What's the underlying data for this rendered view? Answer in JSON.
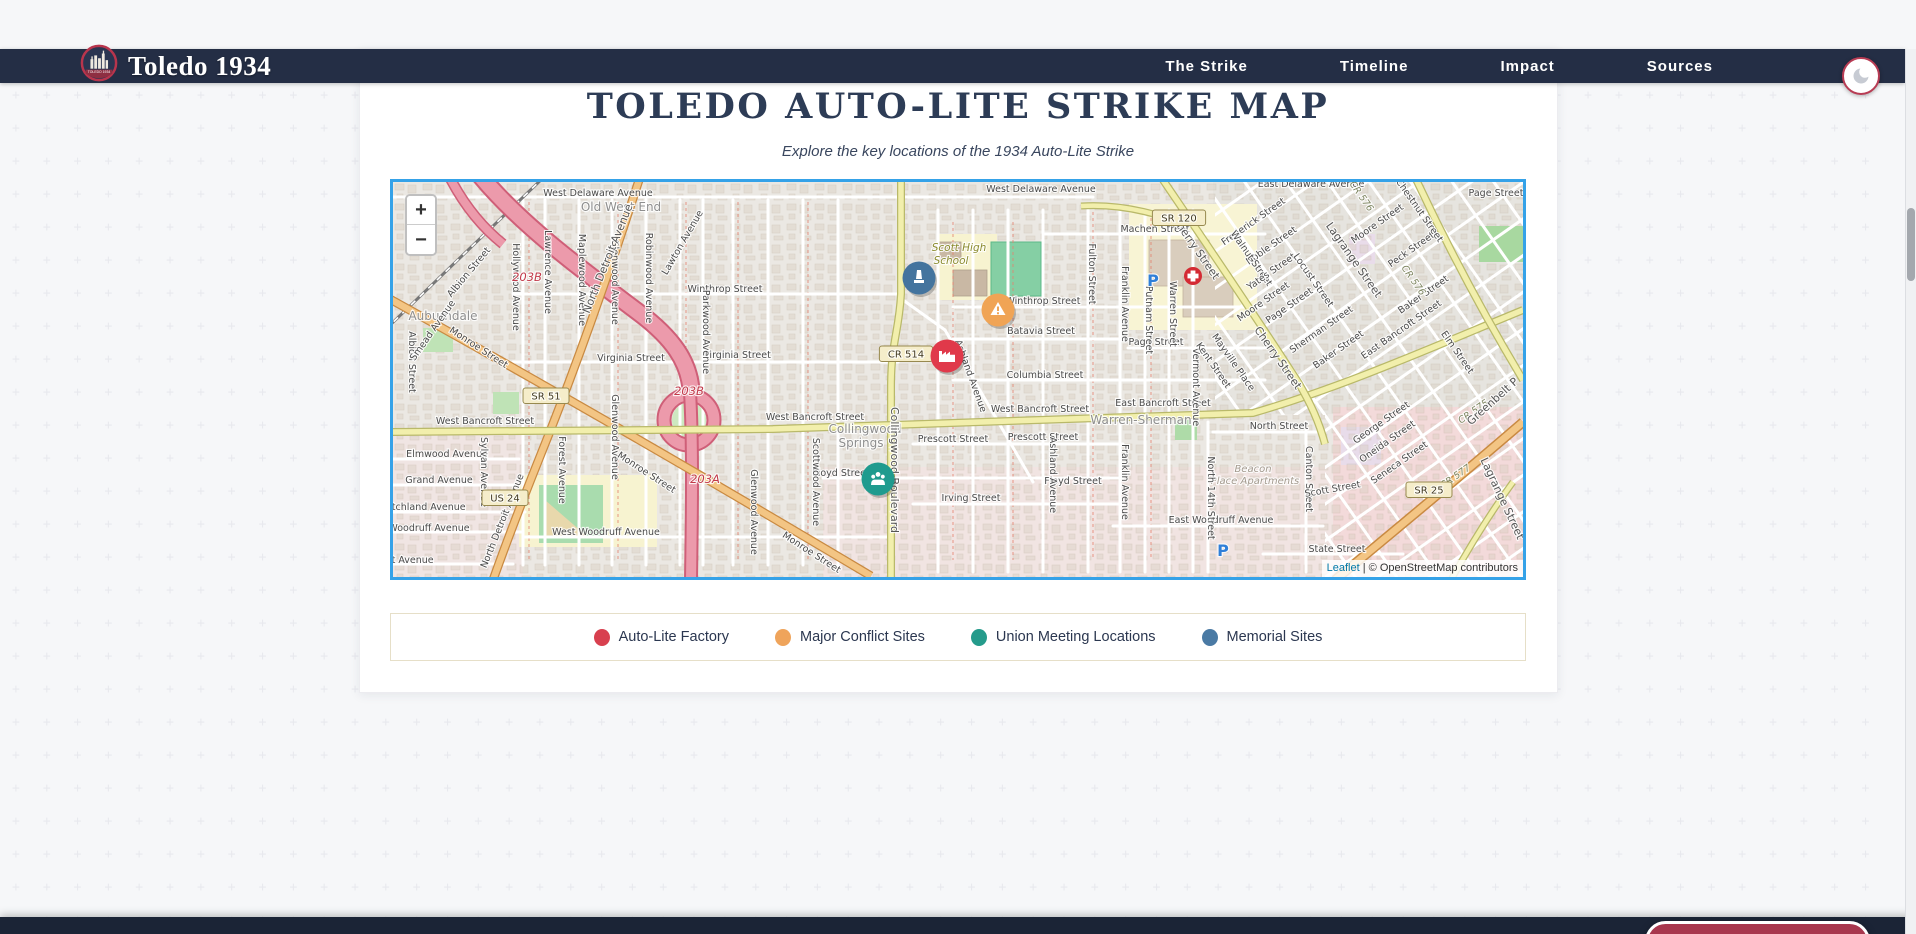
{
  "navbar": {
    "brand": "Toledo 1934",
    "logo_badge_text": "TOLEDO 1934",
    "links": [
      {
        "label": "The Strike"
      },
      {
        "label": "Timeline"
      },
      {
        "label": "Impact"
      },
      {
        "label": "Sources"
      }
    ]
  },
  "hero": {
    "title": "TOLEDO AUTO-LITE STRIKE MAP",
    "subtitle": "Explore the key locations of the 1934 Auto-Lite Strike"
  },
  "map": {
    "zoom_in": "+",
    "zoom_out": "−",
    "attribution": {
      "leaflet": "Leaflet",
      "separator": " | ",
      "osm": "© OpenStreetMap contributors"
    },
    "markers": [
      {
        "name": "Memorial Sites",
        "color": "#44749e",
        "x": 526,
        "y": 96,
        "icon": "memorial"
      },
      {
        "name": "Major Conflict Sites",
        "color": "#f0a455",
        "x": 605,
        "y": 128,
        "icon": "conflict"
      },
      {
        "name": "Auto-Lite Factory",
        "color": "#e0394a",
        "x": 554,
        "y": 174,
        "icon": "factory"
      },
      {
        "name": "Union Meeting Locations",
        "color": "#1f9b8e",
        "x": 485,
        "y": 297,
        "icon": "union"
      }
    ],
    "labels": [
      {
        "t": "West Delaware Avenue",
        "x": 205,
        "y": 14
      },
      {
        "t": "West Delaware Avenue",
        "x": 648,
        "y": 10
      },
      {
        "t": "East Delaware Avenue",
        "x": 918,
        "y": 5
      },
      {
        "t": "Old West End",
        "x": 228,
        "y": 29,
        "k": "area"
      },
      {
        "t": "Auburndale",
        "x": 50,
        "y": 138,
        "k": "area"
      },
      {
        "t": "Machen Street",
        "x": 762,
        "y": 50
      },
      {
        "t": "Winthrop Street",
        "x": 332,
        "y": 110
      },
      {
        "t": "Winthrop Street",
        "x": 650,
        "y": 122
      },
      {
        "t": "Virginia Street",
        "x": 238,
        "y": 179
      },
      {
        "t": "Virginia Street",
        "x": 344,
        "y": 176
      },
      {
        "t": "Batavia Street",
        "x": 648,
        "y": 152
      },
      {
        "t": "Page Street",
        "x": 763,
        "y": 163
      },
      {
        "t": "Columbia Street",
        "x": 652,
        "y": 196
      },
      {
        "t": "West Bancroft Street",
        "x": 92,
        "y": 242
      },
      {
        "t": "West Bancroft Street",
        "x": 422,
        "y": 238
      },
      {
        "t": "West Bancroft Street",
        "x": 647,
        "y": 230
      },
      {
        "t": "East Bancroft Street",
        "x": 770,
        "y": 224
      },
      {
        "t": "Warren-Sherman",
        "x": 748,
        "y": 242,
        "k": "area"
      },
      {
        "t": "Collingwood",
        "x": 472,
        "y": 251,
        "k": "area"
      },
      {
        "t": "Springs",
        "x": 468,
        "y": 265,
        "k": "area"
      },
      {
        "t": "Prescott Street",
        "x": 560,
        "y": 260
      },
      {
        "t": "Prescott Street",
        "x": 650,
        "y": 258
      },
      {
        "t": "Floyd Street",
        "x": 448,
        "y": 294
      },
      {
        "t": "Floyd Street",
        "x": 680,
        "y": 302
      },
      {
        "t": "Irving Street",
        "x": 578,
        "y": 319
      },
      {
        "t": "West Woodruff Avenue",
        "x": 213,
        "y": 353
      },
      {
        "t": "East Woodruff Avenue",
        "x": 828,
        "y": 341
      },
      {
        "t": "Elmwood Avenue",
        "x": 54,
        "y": 275
      },
      {
        "t": "Grand Avenue",
        "x": 46,
        "y": 301
      },
      {
        "t": "Fitchland Avenue",
        "x": 32,
        "y": 328
      },
      {
        "t": "Woodruff Avenue",
        "x": 36,
        "y": 349
      },
      {
        "t": "ct Avenue",
        "x": 17,
        "y": 381
      },
      {
        "t": "State Street",
        "x": 944,
        "y": 370
      },
      {
        "t": "North Street",
        "x": 886,
        "y": 247
      },
      {
        "t": "Beacon",
        "x": 860,
        "y": 290,
        "k": "apt"
      },
      {
        "t": "Place Apartments",
        "x": 862,
        "y": 302,
        "k": "apt"
      },
      {
        "t": "Scott High",
        "x": 566,
        "y": 69,
        "k": "poi"
      },
      {
        "t": "School",
        "x": 558,
        "y": 82,
        "k": "poi"
      },
      {
        "t": "Page Street",
        "x": 1103,
        "y": 14
      },
      {
        "t": "Lawrence Avenue",
        "x": 152,
        "y": 90,
        "r": 90
      },
      {
        "t": "Maplewood Avenue",
        "x": 186,
        "y": 98,
        "r": 90
      },
      {
        "t": "Glenwood Avenue",
        "x": 219,
        "y": 100,
        "r": 90
      },
      {
        "t": "Robinwood Avenue",
        "x": 253,
        "y": 96,
        "r": 90
      },
      {
        "t": "Parkwood Avenue",
        "x": 310,
        "y": 150,
        "r": 90
      },
      {
        "t": "Glenwood Avenue",
        "x": 219,
        "y": 255,
        "r": 90
      },
      {
        "t": "Glenwood Avenue",
        "x": 358,
        "y": 330,
        "r": 90
      },
      {
        "t": "Scottwood Avenue",
        "x": 420,
        "y": 300,
        "r": 90
      },
      {
        "t": "Hollywood Avenue",
        "x": 120,
        "y": 105,
        "r": 90
      },
      {
        "t": "Forest Avenue",
        "x": 166,
        "y": 288,
        "r": 90
      },
      {
        "t": "Sylvan Avenue",
        "x": 88,
        "y": 290,
        "r": 90
      },
      {
        "t": "Albion Street",
        "x": 16,
        "y": 180,
        "r": 90
      },
      {
        "t": "Fulton Street",
        "x": 696,
        "y": 92,
        "r": 90
      },
      {
        "t": "Franklin Avenue",
        "x": 729,
        "y": 122,
        "r": 90
      },
      {
        "t": "Franklin Avenue",
        "x": 729,
        "y": 300,
        "r": 90
      },
      {
        "t": "Putnam Street",
        "x": 753,
        "y": 138,
        "r": 90
      },
      {
        "t": "Warren Street",
        "x": 777,
        "y": 132,
        "r": 90
      },
      {
        "t": "Ashland Avenue",
        "x": 657,
        "y": 293,
        "r": 90
      },
      {
        "t": "Collingwood Boulevard",
        "x": 498,
        "y": 288,
        "r": 90,
        "k": "lg"
      },
      {
        "t": "North 14th Street",
        "x": 815,
        "y": 316,
        "r": 90
      },
      {
        "t": "Canton Street",
        "x": 913,
        "y": 297,
        "r": 90
      },
      {
        "t": "Vermont Avenue",
        "x": 800,
        "y": 205,
        "r": 90
      },
      {
        "t": "Kent Street",
        "x": 818,
        "y": 185,
        "r": 55
      },
      {
        "t": "Mayville Place",
        "x": 838,
        "y": 182,
        "r": 55
      },
      {
        "t": "North Detroit Avenue",
        "x": 218,
        "y": 78,
        "r": -68,
        "k": "lg"
      },
      {
        "t": "North Detroit Avenue",
        "x": 112,
        "y": 340,
        "r": -68
      },
      {
        "t": "Albion Street",
        "x": 78,
        "y": 92,
        "r": -50
      },
      {
        "t": "Lawton Avenue",
        "x": 292,
        "y": 62,
        "r": -60
      },
      {
        "t": "Smead Avenue",
        "x": 42,
        "y": 150,
        "r": -55
      },
      {
        "t": "Monroe Street",
        "x": 84,
        "y": 168,
        "r": 33
      },
      {
        "t": "Monroe Street",
        "x": 252,
        "y": 293,
        "r": 33
      },
      {
        "t": "Monroe Street",
        "x": 417,
        "y": 373,
        "r": 33
      },
      {
        "t": "Ashland Avenue",
        "x": 575,
        "y": 195,
        "r": 70
      },
      {
        "t": "Cherry Street",
        "x": 800,
        "y": 68,
        "r": 55,
        "k": "lg"
      },
      {
        "t": "Cherry Street",
        "x": 882,
        "y": 178,
        "r": 55,
        "k": "lg"
      },
      {
        "t": "Lagrange Street",
        "x": 958,
        "y": 80,
        "r": 55,
        "k": "lg"
      },
      {
        "t": "Lagrange Street",
        "x": 1106,
        "y": 318,
        "r": 65,
        "k": "lg"
      },
      {
        "t": "Frederick Street",
        "x": 862,
        "y": 42,
        "r": -35
      },
      {
        "t": "Noble Street",
        "x": 880,
        "y": 66,
        "r": -35
      },
      {
        "t": "Walnut Street",
        "x": 856,
        "y": 78,
        "r": 55
      },
      {
        "t": "Yates Street",
        "x": 880,
        "y": 92,
        "r": -35
      },
      {
        "t": "Moore Street",
        "x": 872,
        "y": 122,
        "r": -35
      },
      {
        "t": "Moore Street",
        "x": 986,
        "y": 44,
        "r": -35
      },
      {
        "t": "Locust Street",
        "x": 918,
        "y": 100,
        "r": 55
      },
      {
        "t": "Page Street",
        "x": 898,
        "y": 126,
        "r": -35
      },
      {
        "t": "Sherman Street",
        "x": 930,
        "y": 150,
        "r": -35
      },
      {
        "t": "Baker Street",
        "x": 947,
        "y": 170,
        "r": -35
      },
      {
        "t": "Baker Street",
        "x": 1032,
        "y": 115,
        "r": -35
      },
      {
        "t": "Peck Street",
        "x": 1020,
        "y": 70,
        "r": -35
      },
      {
        "t": "Chestnut Street",
        "x": 1024,
        "y": 30,
        "r": 55
      },
      {
        "t": "CR 576",
        "x": 966,
        "y": 16,
        "r": 55,
        "k": "ref2"
      },
      {
        "t": "CR 576",
        "x": 1018,
        "y": 100,
        "r": 55,
        "k": "ref2"
      },
      {
        "t": "East Bancroft Street",
        "x": 1010,
        "y": 150,
        "r": -35
      },
      {
        "t": "Elm Street",
        "x": 1062,
        "y": 172,
        "r": 55
      },
      {
        "t": "George Street",
        "x": 990,
        "y": 243,
        "r": -35
      },
      {
        "t": "Oneida Street",
        "x": 996,
        "y": 262,
        "r": -35
      },
      {
        "t": "Seneca Street",
        "x": 1008,
        "y": 283,
        "r": -35
      },
      {
        "t": "Scott Street",
        "x": 940,
        "y": 310,
        "r": -10
      },
      {
        "t": "CR 575",
        "x": 1082,
        "y": 232,
        "r": -35,
        "k": "ref2"
      },
      {
        "t": "CR 577",
        "x": 1064,
        "y": 297,
        "r": -35,
        "k": "ref2"
      },
      {
        "t": "Greenbelt P",
        "x": 1102,
        "y": 222,
        "r": -42,
        "k": "lg"
      },
      {
        "t": "203B",
        "x": 134,
        "y": 99,
        "k": "ref"
      },
      {
        "t": "203B",
        "x": 296,
        "y": 213,
        "k": "ref"
      },
      {
        "t": "203A",
        "x": 312,
        "y": 301,
        "k": "ref"
      },
      {
        "t": "SR 120",
        "x": 786,
        "y": 36,
        "k": "shield"
      },
      {
        "t": "SR 51",
        "x": 153,
        "y": 214,
        "k": "shield"
      },
      {
        "t": "US 24",
        "x": 112,
        "y": 316,
        "k": "shield"
      },
      {
        "t": "CR 514",
        "x": 513,
        "y": 172,
        "k": "shield"
      },
      {
        "t": "SR 25",
        "x": 1036,
        "y": 308,
        "k": "shield"
      },
      {
        "t": "P",
        "x": 760,
        "y": 104,
        "k": "parking"
      },
      {
        "t": "P",
        "x": 830,
        "y": 374,
        "k": "parking"
      }
    ]
  },
  "legend": {
    "items": [
      {
        "label": "Auto-Lite Factory",
        "color": "#d8404f"
      },
      {
        "label": "Major Conflict Sites",
        "color": "#efa45b"
      },
      {
        "label": "Union Meeting Locations",
        "color": "#259b8b"
      },
      {
        "label": "Memorial Sites",
        "color": "#4a7aa4"
      }
    ]
  },
  "footer": {
    "cta": "Test Your Knowledge!"
  }
}
